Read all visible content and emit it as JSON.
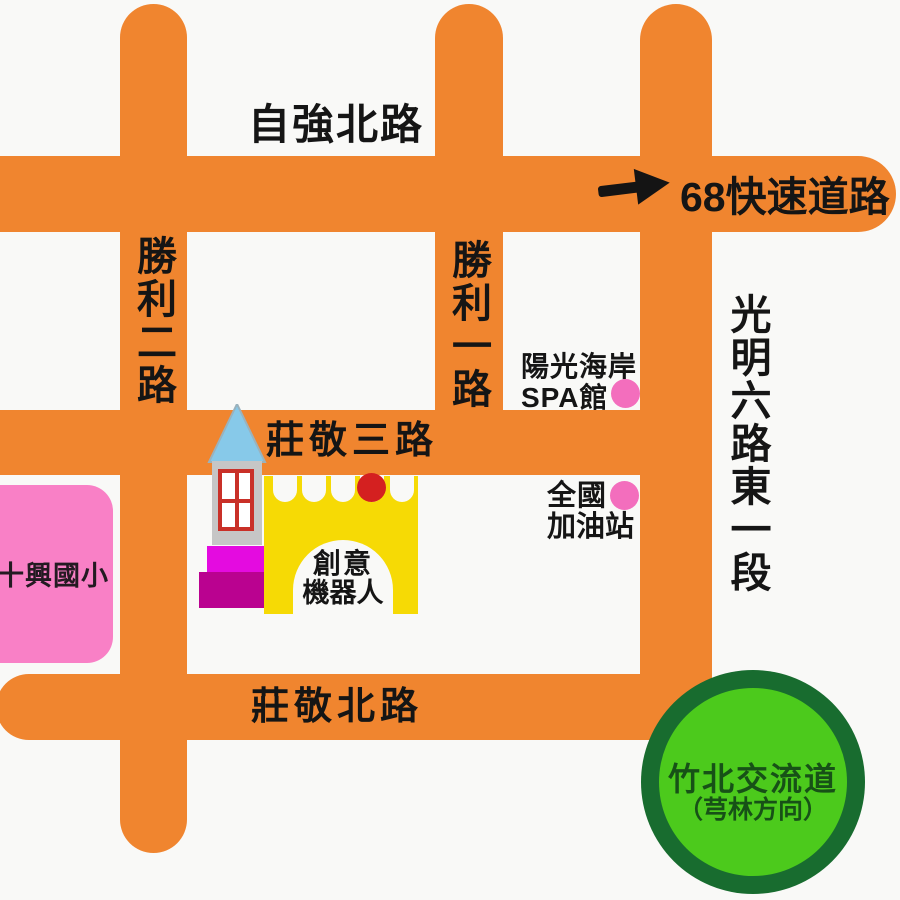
{
  "map": {
    "roads": {
      "zihqiang_north": "自強北路",
      "expressway_68": "68快速道路",
      "shengli_2": "勝利二路",
      "shengli_1": "勝利一路",
      "guangming_6_east_1": "光明六路東一段",
      "zhuangjing_3": "莊敬三路",
      "zhuangjing_north": "莊敬北路"
    },
    "places": {
      "school": "十興國小",
      "spa": {
        "line1": "陽光海岸",
        "line2": "SPA館"
      },
      "gas_station": {
        "line1": "全國",
        "line2": "加油站"
      },
      "robot_castle": {
        "line1": "創意",
        "line2": "機器人"
      },
      "interchange": {
        "line1": "竹北交流道",
        "line2": "（芎林方向）"
      }
    },
    "icons": {
      "direction_arrow": "arrow-right-icon",
      "destination_marker": "red-dot-marker",
      "spa_marker": "pink-dot-marker",
      "gas_marker": "pink-dot-marker"
    },
    "colors": {
      "road_orange": "#F0852F",
      "school_pink": "#F980C6",
      "poi_dot_pink": "#F36EBD",
      "marker_red": "#D42020",
      "castle_yellow": "#F6DA05",
      "spire_blue": "#87C9E9",
      "tower_gray": "#C6C6C6",
      "window_frame_red": "#C93028",
      "block_magenta": "#E40BE0",
      "block_purple": "#BA0290",
      "interchange_ring_green": "#186C2F",
      "interchange_fill_green": "#4CCA1C",
      "interchange_text_green": "#175117",
      "label_black": "#151515"
    }
  }
}
